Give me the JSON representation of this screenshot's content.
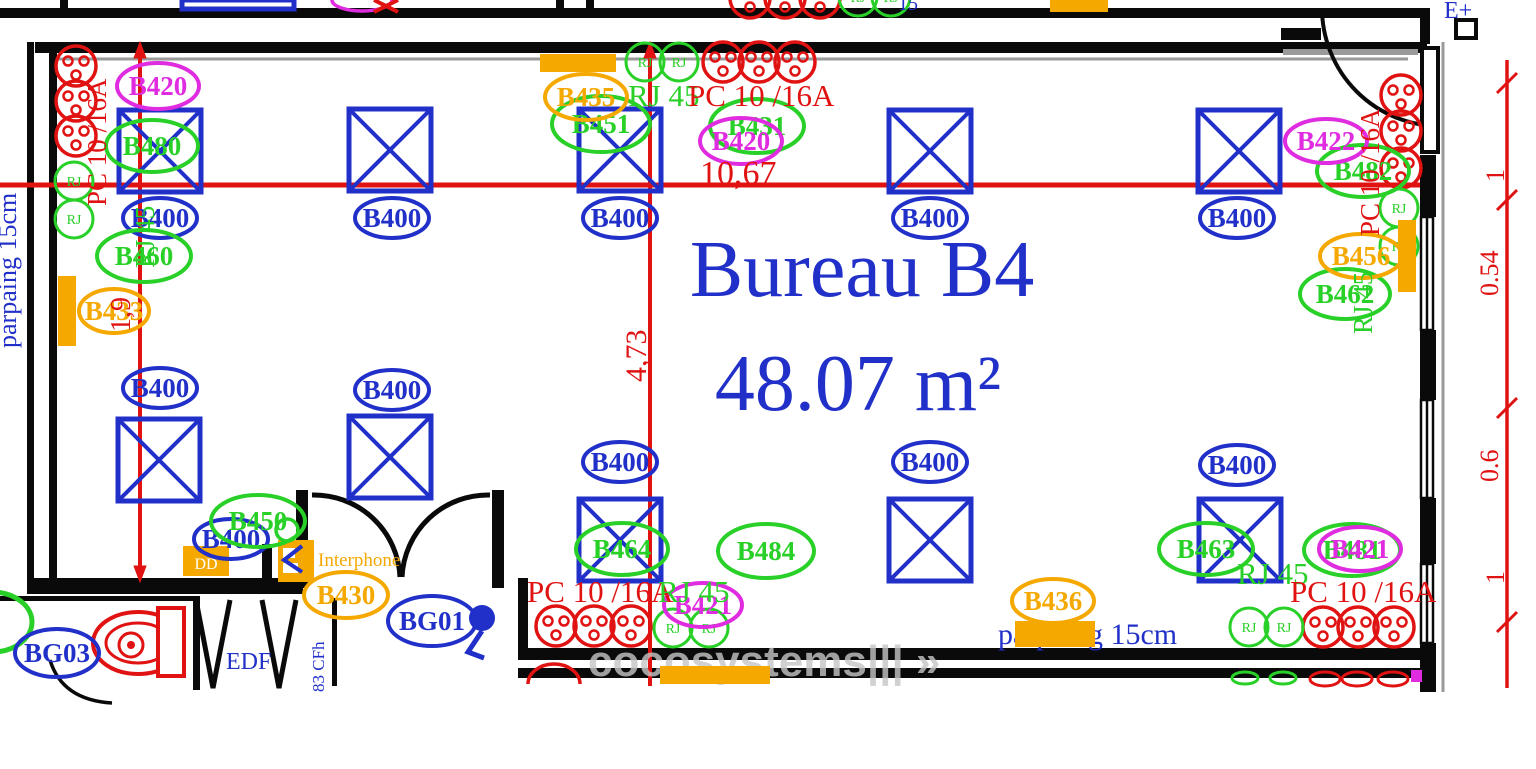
{
  "plan": {
    "meta": {
      "room_label": "Bureau B4",
      "area_label": "48.07 m²",
      "drawing_type": "electrical-floor-plan"
    },
    "colors": {
      "blue": "#2030c8",
      "green": "#28d028",
      "magenta": "#e02ce0",
      "orange": "#f5a800",
      "red": "#e01212",
      "grey": "#c6c6c6",
      "white": "#fffdf5",
      "wall": "#0a0a0a",
      "window": "#9a9a9a"
    },
    "rj_text": "RJ",
    "lights": [
      [
        160,
        151
      ],
      [
        390,
        150
      ],
      [
        620,
        150
      ],
      [
        930,
        151
      ],
      [
        1239,
        151
      ],
      [
        159,
        460
      ],
      [
        390,
        457
      ],
      [
        620,
        540
      ],
      [
        930,
        540
      ],
      [
        1240,
        540
      ]
    ],
    "outlets": [
      [
        76,
        66
      ],
      [
        76,
        101
      ],
      [
        76,
        136
      ],
      [
        723,
        62
      ],
      [
        759,
        62
      ],
      [
        795,
        62
      ],
      [
        1401,
        95
      ],
      [
        1401,
        131
      ],
      [
        1401,
        168
      ],
      [
        556,
        626
      ],
      [
        594,
        626
      ],
      [
        631,
        626
      ],
      [
        1323,
        627
      ],
      [
        1358,
        627
      ],
      [
        1394,
        627
      ],
      [
        750,
        -2
      ],
      [
        785,
        -2
      ],
      [
        820,
        -2
      ]
    ],
    "rj_ports": [
      [
        74,
        181
      ],
      [
        74,
        219
      ],
      [
        645,
        62
      ],
      [
        679,
        62
      ],
      [
        1399,
        208
      ],
      [
        1399,
        246
      ],
      [
        673,
        628
      ],
      [
        709,
        628
      ],
      [
        1249,
        627
      ],
      [
        1284,
        627
      ],
      [
        858,
        -3
      ],
      [
        891,
        -3
      ]
    ],
    "tags": [
      {
        "t": "B400",
        "c": "blue",
        "x": 160,
        "y": 218,
        "rx": 37,
        "ry": 20
      },
      {
        "t": "B400",
        "c": "blue",
        "x": 392,
        "y": 218,
        "rx": 37,
        "ry": 20
      },
      {
        "t": "B400",
        "c": "blue",
        "x": 620,
        "y": 218,
        "rx": 37,
        "ry": 20
      },
      {
        "t": "B400",
        "c": "blue",
        "x": 930,
        "y": 218,
        "rx": 37,
        "ry": 20
      },
      {
        "t": "B400",
        "c": "blue",
        "x": 1237,
        "y": 218,
        "rx": 37,
        "ry": 20
      },
      {
        "t": "B400",
        "c": "blue",
        "x": 160,
        "y": 388,
        "rx": 37,
        "ry": 20
      },
      {
        "t": "B400",
        "c": "blue",
        "x": 392,
        "y": 390,
        "rx": 37,
        "ry": 20
      },
      {
        "t": "B400",
        "c": "blue",
        "x": 620,
        "y": 462,
        "rx": 37,
        "ry": 20
      },
      {
        "t": "B400",
        "c": "blue",
        "x": 930,
        "y": 462,
        "rx": 37,
        "ry": 20
      },
      {
        "t": "B400",
        "c": "blue",
        "x": 1237,
        "y": 465,
        "rx": 37,
        "ry": 20
      },
      {
        "t": "B400",
        "c": "blue",
        "x": 231,
        "y": 539,
        "rx": 37,
        "ry": 20
      },
      {
        "t": "BG03",
        "c": "blue",
        "x": 57,
        "y": 653,
        "rx": 42,
        "ry": 24
      },
      {
        "t": "BG01",
        "c": "blue",
        "x": 432,
        "y": 621,
        "rx": 44,
        "ry": 25
      },
      {
        "t": "B480",
        "c": "green",
        "x": 152,
        "y": 146,
        "rx": 46,
        "ry": 26
      },
      {
        "t": "B460",
        "c": "green",
        "x": 144,
        "y": 256,
        "rx": 47,
        "ry": 26
      },
      {
        "t": "B450",
        "c": "green",
        "x": 258,
        "y": 521,
        "rx": 47,
        "ry": 26
      },
      {
        "t": "B451",
        "c": "green",
        "x": 601,
        "y": 124,
        "rx": 49,
        "ry": 28
      },
      {
        "t": "B431",
        "c": "green",
        "x": 757,
        "y": 126,
        "rx": 47,
        "ry": 27
      },
      {
        "t": "B482",
        "c": "green",
        "x": 1363,
        "y": 171,
        "rx": 46,
        "ry": 26
      },
      {
        "t": "B462",
        "c": "green",
        "x": 1345,
        "y": 294,
        "rx": 45,
        "ry": 25
      },
      {
        "t": "B463",
        "c": "green",
        "x": 1206,
        "y": 549,
        "rx": 47,
        "ry": 26
      },
      {
        "t": "B484",
        "c": "green",
        "x": 766,
        "y": 551,
        "rx": 48,
        "ry": 27
      },
      {
        "t": "B464",
        "c": "green",
        "x": 622,
        "y": 549,
        "rx": 46,
        "ry": 26
      },
      {
        "t": "B481",
        "c": "green",
        "x": 1352,
        "y": 550,
        "rx": 48,
        "ry": 26
      },
      {
        "t": "B420",
        "c": "magenta",
        "x": 158,
        "y": 86,
        "rx": 41,
        "ry": 23
      },
      {
        "t": "B420",
        "c": "magenta",
        "x": 741,
        "y": 141,
        "rx": 41,
        "ry": 23
      },
      {
        "t": "B422",
        "c": "magenta",
        "x": 1326,
        "y": 141,
        "rx": 41,
        "ry": 22
      },
      {
        "t": "B421",
        "c": "magenta",
        "x": 703,
        "y": 605,
        "rx": 39,
        "ry": 22
      },
      {
        "t": "B421",
        "c": "magenta",
        "x": 1360,
        "y": 549,
        "rx": 41,
        "ry": 22
      },
      {
        "t": "B435",
        "c": "orange",
        "x": 586,
        "y": 97,
        "rx": 41,
        "ry": 23
      },
      {
        "t": "B433",
        "c": "orange",
        "x": 114,
        "y": 311,
        "rx": 35,
        "ry": 22
      },
      {
        "t": "B430",
        "c": "orange",
        "x": 346,
        "y": 595,
        "rx": 42,
        "ry": 23
      },
      {
        "t": "B436",
        "c": "orange",
        "x": 1053,
        "y": 601,
        "rx": 41,
        "ry": 22
      },
      {
        "t": "B456",
        "c": "orange",
        "x": 1361,
        "y": 256,
        "rx": 41,
        "ry": 22
      }
    ],
    "texts": [
      {
        "t": "RJ 45",
        "c": "green",
        "x": 628,
        "y": 106,
        "s": 31
      },
      {
        "t": "PC 10 /16A",
        "c": "red",
        "x": 688,
        "y": 106,
        "s": 31
      },
      {
        "t": "10,67",
        "c": "red",
        "x": 700,
        "y": 184,
        "s": 34
      },
      {
        "t": "4,73",
        "c": "red",
        "x": 646,
        "y": 382,
        "s": 30,
        "r": -90
      },
      {
        "t": "1,9",
        "c": "red",
        "x": 130,
        "y": 332,
        "s": 28,
        "r": -90
      },
      {
        "t": "PC 10 /16A",
        "c": "red",
        "x": 106,
        "y": 206,
        "s": 27,
        "r": -90
      },
      {
        "t": "RJ 45",
        "c": "green",
        "x": 154,
        "y": 268,
        "s": 27,
        "r": -90
      },
      {
        "t": "PC 10 /16A",
        "c": "red",
        "x": 1379,
        "y": 236,
        "s": 27,
        "r": -90
      },
      {
        "t": "RJ 45",
        "c": "green",
        "x": 1372,
        "y": 334,
        "s": 27,
        "r": -90
      },
      {
        "t": "PC 10 /16A",
        "c": "red",
        "x": 527,
        "y": 602,
        "s": 31
      },
      {
        "t": "RJ 45",
        "c": "green",
        "x": 658,
        "y": 602,
        "s": 31
      },
      {
        "t": "RJ 45",
        "c": "green",
        "x": 1237,
        "y": 584,
        "s": 31
      },
      {
        "t": "PC 10 /16A",
        "c": "red",
        "x": 1290,
        "y": 602,
        "s": 31
      },
      {
        "t": "parpaing 15cm",
        "c": "blue",
        "x": 16,
        "y": 348,
        "s": 26,
        "r": -90
      },
      {
        "t": "parpaing 15cm",
        "c": "blue",
        "x": 998,
        "y": 644,
        "s": 30
      },
      {
        "t": "EDF",
        "c": "blue",
        "x": 226,
        "y": 669,
        "s": 24
      },
      {
        "t": "83 CFh",
        "c": "blue",
        "x": 324,
        "y": 692,
        "s": 17,
        "r": -90
      },
      {
        "t": "E+",
        "c": "blue",
        "x": 1444,
        "y": 18,
        "s": 24
      },
      {
        "t": "Interphone",
        "c": "orange",
        "x": 318,
        "y": 566,
        "s": 19
      },
      {
        "t": "1",
        "c": "red",
        "x": 1504,
        "y": 182,
        "s": 26,
        "r": -90
      },
      {
        "t": "0.54",
        "c": "red",
        "x": 1498,
        "y": 296,
        "s": 26,
        "r": -90
      },
      {
        "t": "0.6",
        "c": "red",
        "x": 1498,
        "y": 482,
        "s": 26,
        "r": -90
      },
      {
        "t": "1",
        "c": "red",
        "x": 1504,
        "y": 584,
        "s": 26,
        "r": -90
      },
      {
        "t": "15",
        "c": "blue",
        "x": 898,
        "y": 10,
        "s": 20
      },
      {
        "t": "Bureau B4",
        "c": "blue",
        "x": 862,
        "y": 296,
        "s": 80,
        "a": "middle"
      },
      {
        "t": "48.07 m²",
        "c": "blue",
        "x": 858,
        "y": 410,
        "s": 80,
        "a": "middle"
      },
      {
        "t": "cocosystems||| »",
        "c": "grey",
        "x": 588,
        "y": 676,
        "s": 44,
        "f": "sans",
        "w": 700,
        "o": 0.8
      },
      {
        "t": "DD",
        "c": "white",
        "x": 206,
        "y": 569,
        "s": 16,
        "a": "middle"
      }
    ],
    "orange_rects": [
      [
        540,
        54,
        76,
        18
      ],
      [
        1050,
        0,
        58,
        12
      ],
      [
        58,
        276,
        18,
        70
      ],
      [
        1398,
        220,
        18,
        72
      ],
      [
        1015,
        621,
        80,
        26
      ],
      [
        660,
        666,
        110,
        18
      ]
    ],
    "dim_ticks": [
      83,
      200,
      408,
      622
    ]
  }
}
